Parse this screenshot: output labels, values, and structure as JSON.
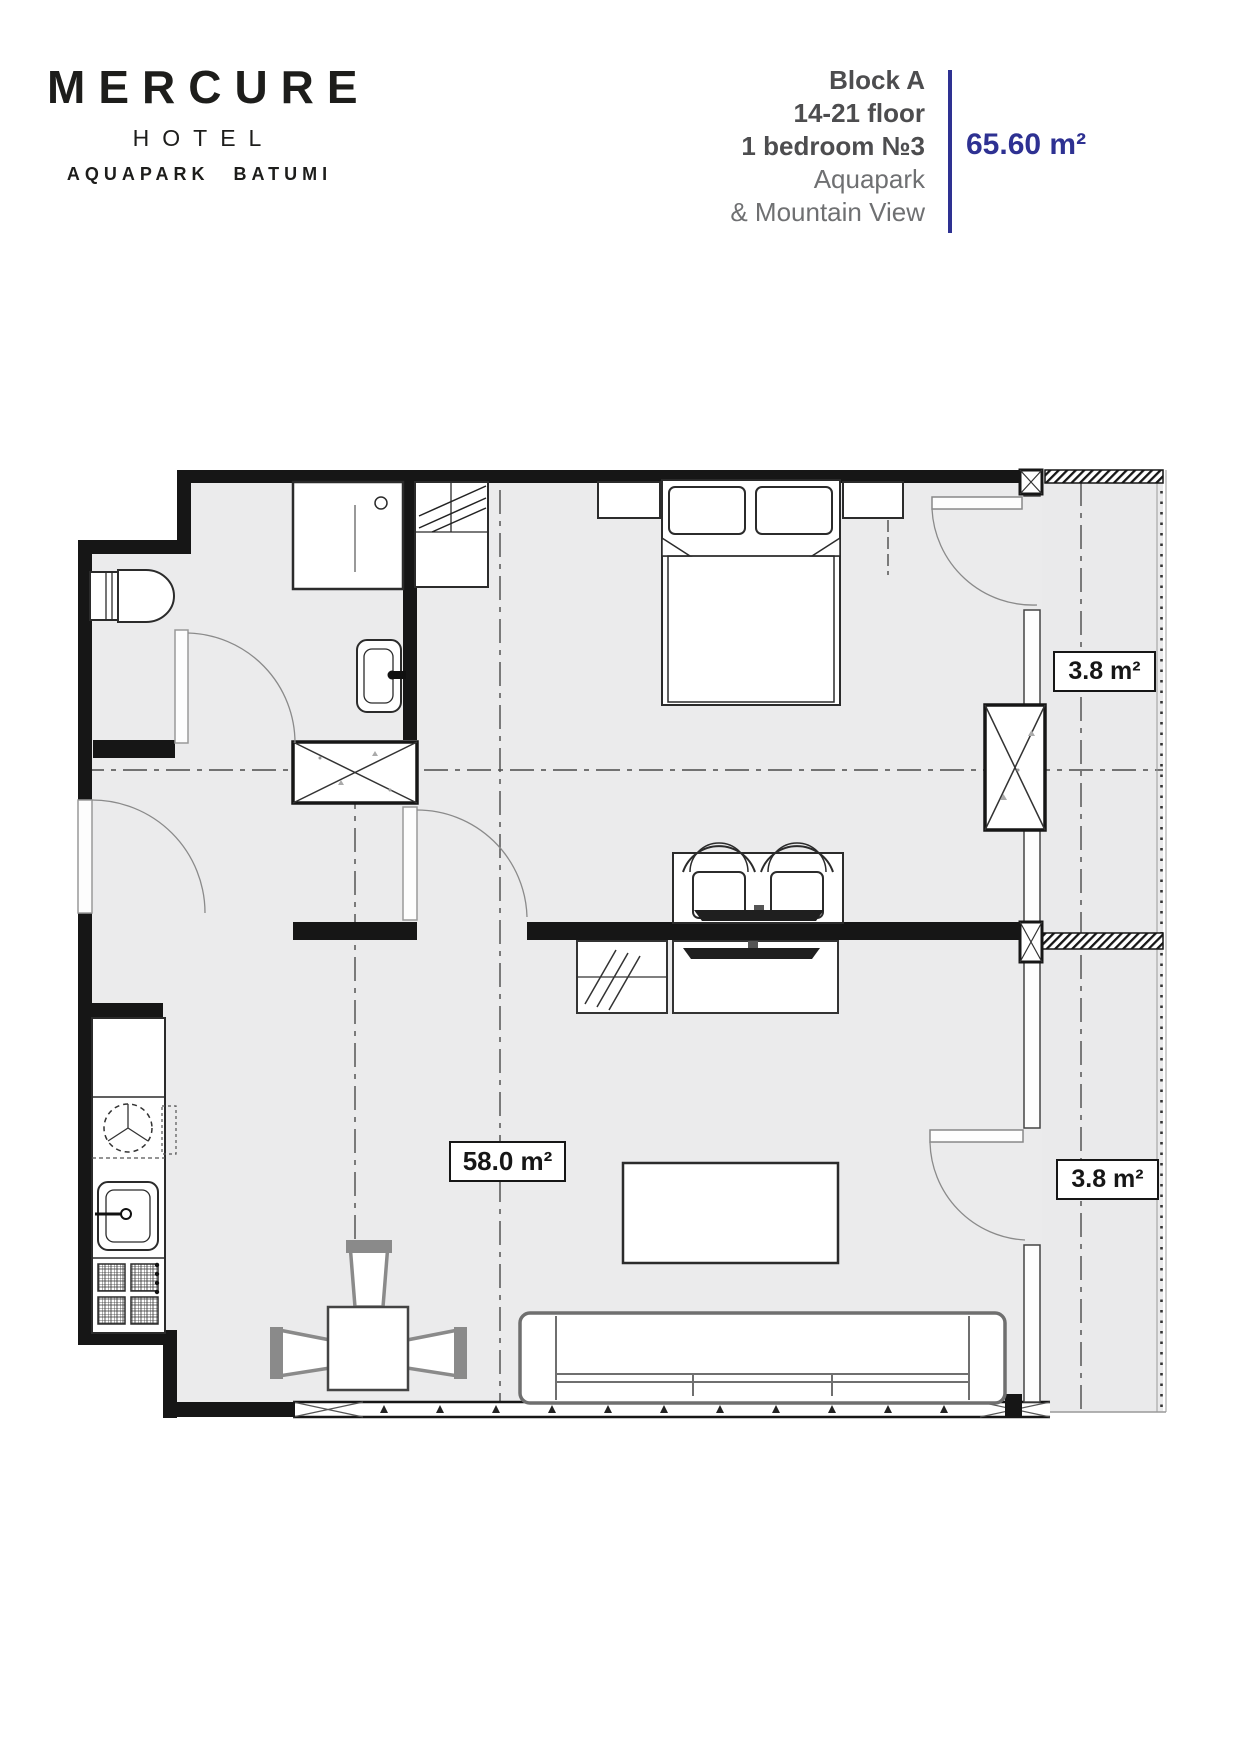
{
  "header": {
    "logo": {
      "brand": "MERCURE",
      "word": "HOTEL",
      "location": "AQUAPARK BATUMI"
    },
    "unit": {
      "block": "Block A",
      "floor_range": "14-21 floor",
      "unit_type": "1 bedroom №3",
      "view_line1": "Aquapark",
      "view_line2": "& Mountain View",
      "total_area": "65.60 m²"
    },
    "accent_color": "#2e3192",
    "text_dark": "#4d4d4f",
    "text_gray": "#6f7072"
  },
  "plan": {
    "area_labels": {
      "main": "58.0 m²",
      "balcony_top": "3.8 m²",
      "balcony_bottom": "3.8 m²"
    },
    "colors": {
      "floor_fill": "#ebebec",
      "wall": "#161616"
    }
  }
}
